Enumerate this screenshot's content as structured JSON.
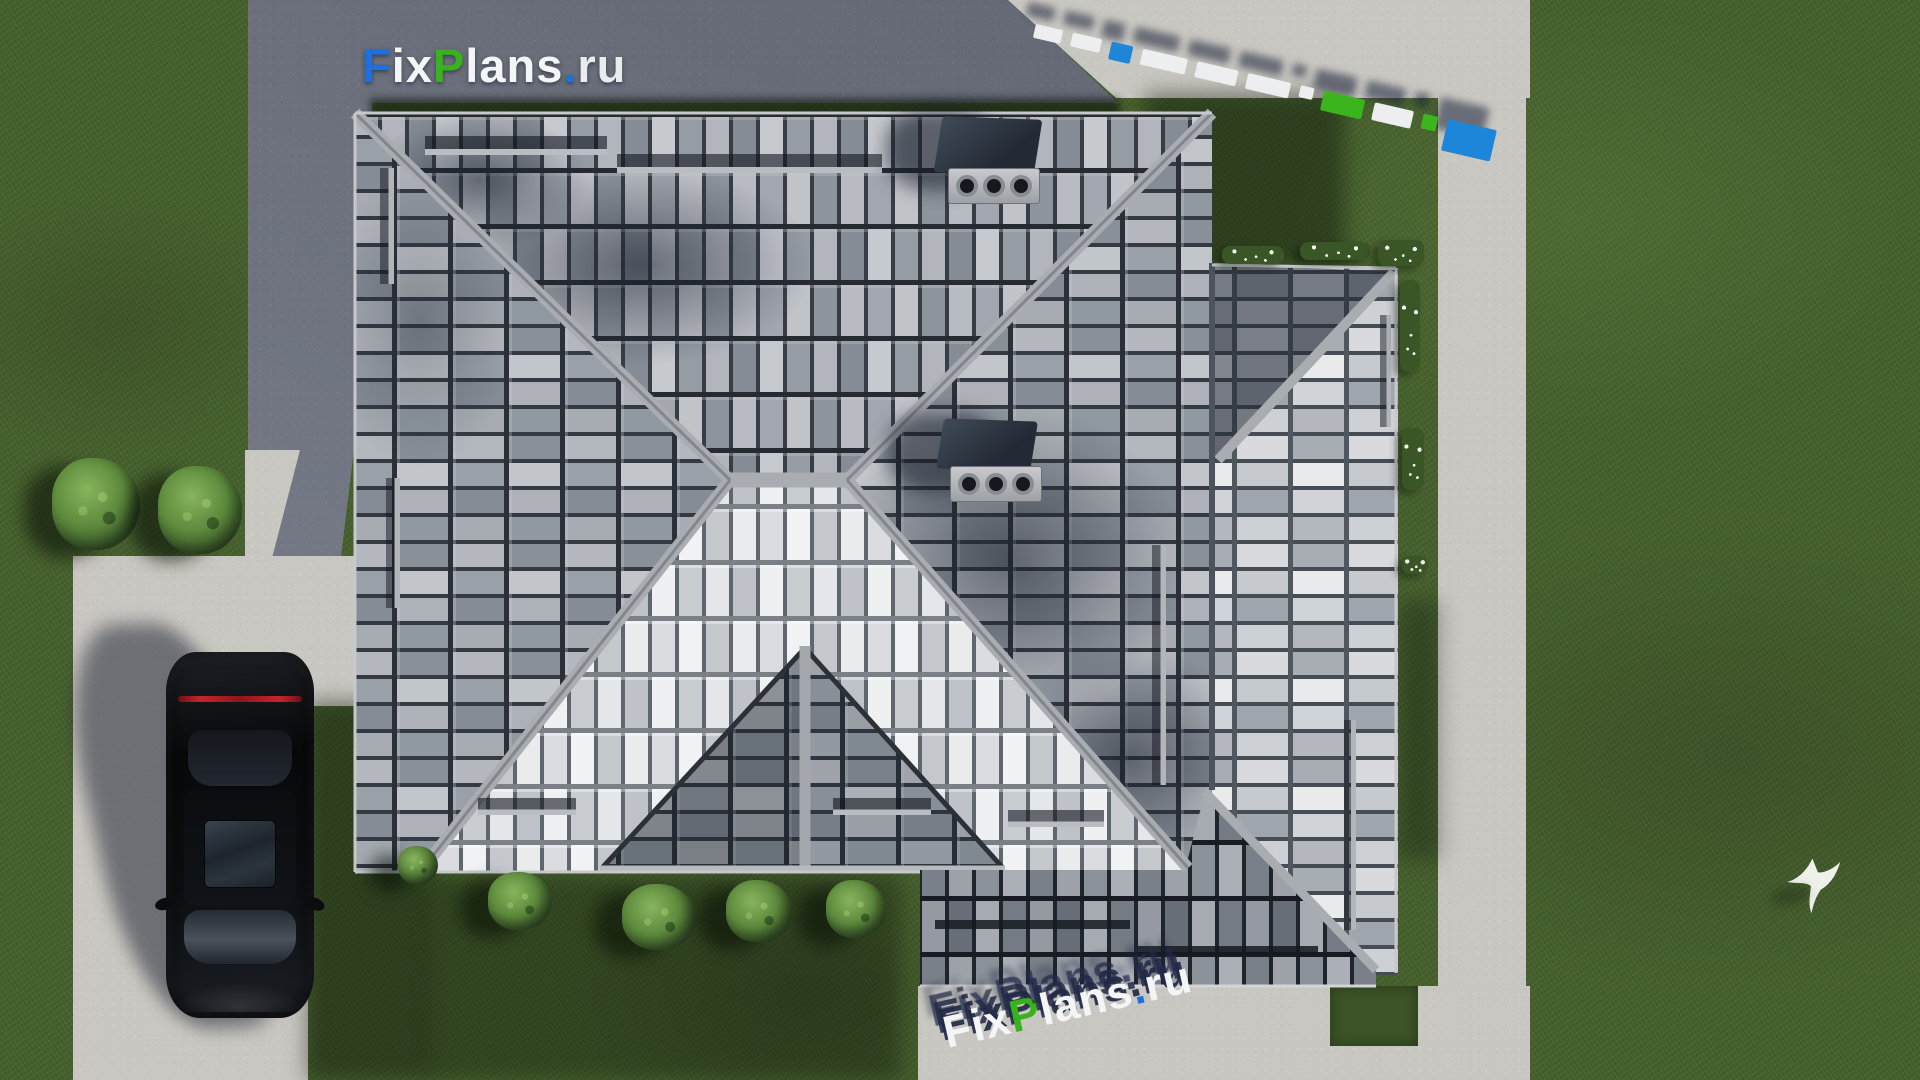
{
  "logo": {
    "text": "FixPlans.ru",
    "parts": [
      {
        "text": "F",
        "color": "#1e6fe0"
      },
      {
        "text": "ix",
        "color": "#f4f5f7"
      },
      {
        "text": "P",
        "color": "#38b31c"
      },
      {
        "text": "lans",
        "color": "#f4f5f7"
      },
      {
        "text": ".",
        "color": "#1e6fe0"
      },
      {
        "text": "ru",
        "color": "#e9ebee"
      }
    ]
  },
  "watermarks": {
    "top_left": {
      "text": "FixPlans.ru",
      "style": "flat logo on dark paving"
    },
    "top_right": {
      "text": "FixPlans.ru",
      "style": "3d extruded blocks lying on pavement"
    },
    "bottom": {
      "text": "FixPlans.ru",
      "style": "3d extruded letters on pavement"
    }
  },
  "palette": {
    "grass": "#47612e",
    "grass_shadow": "#2e4420",
    "paving_dark": "#6d7280",
    "path_light": "#c9c7c1",
    "roof_medium": "#9aa0a8",
    "roof_light": "#e9ebee",
    "roof_dark": "#70767f",
    "ridge": "#a9acb1",
    "logo_blue": "#1e6fe0",
    "logo_green": "#38b31c",
    "car_black": "#0b0d10",
    "taillight_red": "#c62430"
  },
  "scene": {
    "objects": [
      "hip-roof-house",
      "black-sedan-car",
      "white-bird",
      "garden-bushes",
      "flower-beds",
      "concrete-paths",
      "dark-paved-driveway",
      "lawn"
    ]
  }
}
